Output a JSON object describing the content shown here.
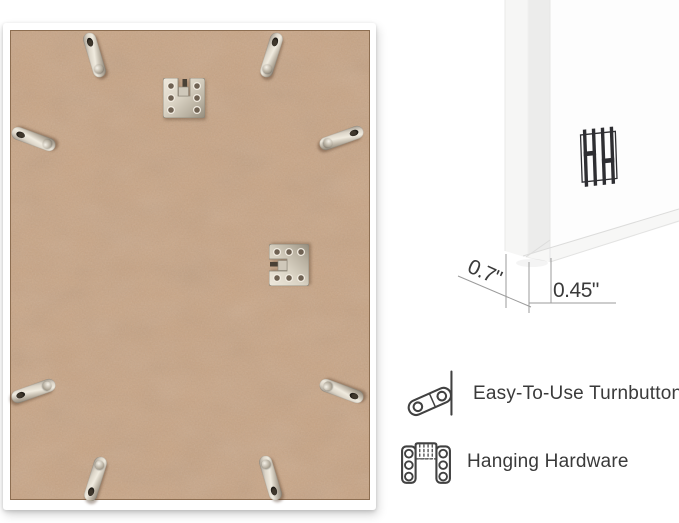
{
  "colors": {
    "pageBg": "#ffffff",
    "frameWhite": "#ffffff",
    "mdf": "#c8a484",
    "mdfShadow": "#8a7055",
    "metalLight": "#eee8dc",
    "metalDark": "#8f887a",
    "text": "#3a3a3a",
    "dimLine": "#9b9b9b",
    "iconStroke": "#414141",
    "logo": "#2e2e32"
  },
  "measurements": {
    "depth_label": "0.7\"",
    "width_label": "0.45\""
  },
  "features": {
    "items": [
      {
        "icon": "turnbutton-icon",
        "label": "Easy-To-Use Turnbuttons"
      },
      {
        "icon": "hanging-hardware-icon",
        "label": "Hanging Hardware"
      }
    ]
  },
  "brand_logo": {
    "icon": "hh-bars-logo"
  }
}
